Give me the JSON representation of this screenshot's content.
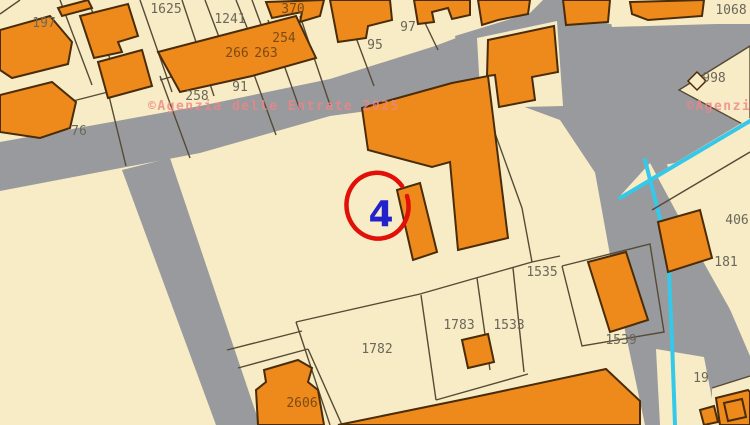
{
  "map": {
    "watermark": "©Agenzia delle Entrate 2025",
    "marker": {
      "label": "4"
    },
    "parcel_labels": [
      {
        "label": "197"
      },
      {
        "label": "1625"
      },
      {
        "label": "1241"
      },
      {
        "label": "370"
      },
      {
        "label": "254"
      },
      {
        "label": "266"
      },
      {
        "label": "263"
      },
      {
        "label": "91"
      },
      {
        "label": "95"
      },
      {
        "label": "97"
      },
      {
        "label": "258"
      },
      {
        "label": "76"
      },
      {
        "label": "1068"
      },
      {
        "label": "998"
      },
      {
        "label": "406"
      },
      {
        "label": "181"
      },
      {
        "label": "1535"
      },
      {
        "label": "1783"
      },
      {
        "label": "1533"
      },
      {
        "label": "1782"
      },
      {
        "label": "1539"
      },
      {
        "label": "2606"
      },
      {
        "label": "19"
      }
    ],
    "colors": {
      "parcel_fill": "#f7ecc6",
      "building_fill": "#ee8a1c",
      "road_fill": "#999a9e",
      "water_boundary": "#35c8e8",
      "marker_circle": "#e11008",
      "marker_number": "#2222cc",
      "watermark_pink": "#ee8585"
    }
  }
}
